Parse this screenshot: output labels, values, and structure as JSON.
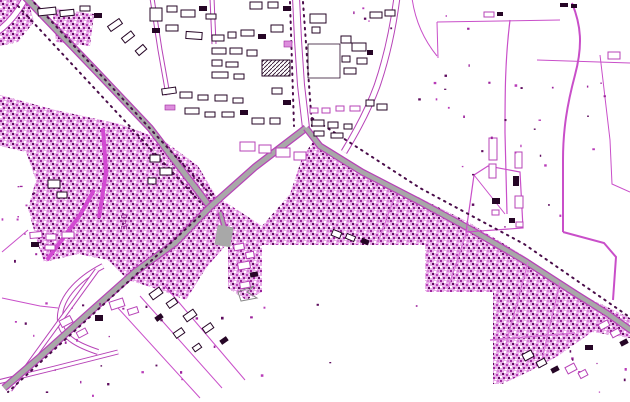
{
  "map": {
    "background": "#ffffff",
    "label": {
      "text": "340",
      "x": 127,
      "y": 230,
      "rotation": -90
    },
    "colors": {
      "road_fill": "#a8a8a8",
      "road_casing": "#b743b7",
      "minor_line": "#c94fc9",
      "strong_line": "#c13fc1",
      "bright_street": "#d24ad2",
      "band_street": "#d678d6",
      "tree_dots": "#4a0d4a",
      "dark_ink": "#260626",
      "texture_base": "#e8b0e8",
      "texture_mid": "#b83cb8",
      "texture_dark": "#9c239c",
      "texture_deep": "#5f0d5f",
      "texture_light": "#d77fd7",
      "building_pink": "#dd8edd",
      "label_color": "#8a1f8a",
      "gray_outline": "#8a8a8a"
    },
    "texture_areas": [
      "0,95 55,110 120,124 163,140 198,166 216,196 262,226 262,245 226,245 206,268 186,300 160,290 128,280 108,260 78,254 44,262 36,238 28,208 36,180 26,152 0,146",
      "0,0 28,0 34,22 18,42 0,46",
      "52,8 94,14 90,46 56,42",
      "262,226 290,194 302,158 314,140 334,152 364,172 420,198 468,222 524,256 576,292 630,318 630,338 592,332 558,356 528,372 502,384 493,384 493,292 425,292 425,245 262,245",
      "228,228 262,228 262,292 246,300 228,288"
    ],
    "gray_roads": [
      {
        "d": "M 24,-4 L 95,70 L 150,128 L 210,207",
        "w": 5
      },
      {
        "d": "M 210,207 L 175,243 L 135,272 L 90,312 L 40,357 L 4,388",
        "w": 5
      },
      {
        "d": "M 210,207 L 255,167 L 306,128",
        "w": 5
      },
      {
        "d": "M 306,128 L 320,146 L 362,172 L 420,202 L 470,229 L 525,261 L 576,294 L 608,314 L 632,331",
        "w": 4.5
      },
      {
        "d": "M 220,212 L 227,236",
        "w": 3
      }
    ],
    "gray_patches": [
      {
        "x": 216,
        "y": 226,
        "w": 16,
        "h": 20,
        "r": 10
      }
    ],
    "white_roads": [
      {
        "d": "M 296,-3 L 298,40 L 301,85 L 306,128",
        "w": 6
      },
      {
        "d": "M -3,32 Q 14,20 26,-3",
        "w": 5
      },
      {
        "d": "M 397,-3 Q 391,45 377,86 Q 366,116 344,152",
        "w": 5
      },
      {
        "d": "M 103,266 C 76,280 58,300 60,322 C 62,338 80,346 98,352",
        "w": 4
      },
      {
        "d": "M 97,270 L 10,390",
        "w": 3
      },
      {
        "d": "M -2,382 L 55,368 L 118,352",
        "w": 3
      },
      {
        "d": "M 152,-2 L 160,50 L 168,95",
        "w": 3
      },
      {
        "d": "M 212,-2 L 214,44",
        "w": 3
      }
    ],
    "bright_streets": [
      {
        "d": "M 103,128 L 106,172 L 99,218",
        "w": 4
      },
      {
        "d": "M 47,260 L 80,215 L 94,190",
        "w": 4
      }
    ],
    "band_streets": [
      {
        "d": "M 395,196 L 378,242",
        "w": 1.3
      },
      {
        "d": "M 468,228 L 448,288",
        "w": 1.3
      },
      {
        "d": "M 528,262 L 506,344",
        "w": 1.3
      },
      {
        "d": "M 560,282 L 540,368",
        "w": 1.3
      },
      {
        "d": "M 490,340 L 575,333",
        "w": 1.5
      }
    ],
    "field_lines": [
      {
        "d": "M 437,22 L 560,20",
        "w": 1
      },
      {
        "d": "M 437,22 L 438,58",
        "w": 1
      },
      {
        "d": "M 510,20 C 505,60 505,95 505,133 L 507,214",
        "w": 1.2
      },
      {
        "d": "M 572,3 C 581,25 583,45 575,75 C 567,105 563,130 563,160 L 563,232",
        "w": 2
      },
      {
        "d": "M 563,232 L 604,243 L 616,257 L 613,300",
        "w": 2
      },
      {
        "d": "M 466,232 L 474,175 L 488,166 L 520,172 L 523,228 Z",
        "w": 1.2
      },
      {
        "d": "M 474,175 L 505,214",
        "w": 1
      },
      {
        "d": "M 600,55 L 610,140 L 612,184 L 630,192",
        "w": 1
      },
      {
        "d": "M 537,60 L 630,63",
        "w": 1
      },
      {
        "d": "M 412,-2 C 415,20 424,40 437,56",
        "w": 1
      },
      {
        "d": "M 118,308 L 200,398",
        "w": 1
      },
      {
        "d": "M 140,296 L 222,388",
        "w": 1
      },
      {
        "d": "M 165,286 L 245,380",
        "w": 1
      },
      {
        "d": "M 28,230 L 2,252",
        "w": 1
      },
      {
        "d": "M 2,298 L 40,306 L 58,308",
        "w": 1
      }
    ],
    "tree_lines": [
      "M 312,118 L 420,188 L 524,244 L 628,316",
      "M 18,6 L 200,202",
      "M 30,-2 L 212,196",
      "M 200,216 L 8,392",
      "M 290,2 L 294,126",
      "M 303,2 L 312,126"
    ],
    "outline_paths": [
      {
        "d": "M 308,44 L 340,44 L 340,78 L 308,78 Z",
        "stroke": "#260626",
        "w": 0.8
      },
      {
        "d": "M 238,292 L 254,286 L 247,292 L 257,298 L 241,301 Z",
        "stroke": "#8a8a8a",
        "w": 1
      }
    ],
    "buildings": [
      [
        38,
        8,
        18,
        7,
        -6,
        "d"
      ],
      [
        60,
        10,
        14,
        6,
        -6,
        "d"
      ],
      [
        80,
        6,
        10,
        5,
        0,
        "d"
      ],
      [
        94,
        13,
        8,
        5,
        0,
        "k"
      ],
      [
        108,
        22,
        14,
        6,
        -35,
        "d"
      ],
      [
        122,
        34,
        12,
        6,
        -38,
        "d"
      ],
      [
        136,
        47,
        10,
        6,
        -40,
        "d"
      ],
      [
        150,
        8,
        12,
        13,
        0,
        "d"
      ],
      [
        167,
        6,
        10,
        6,
        0,
        "d"
      ],
      [
        181,
        10,
        14,
        7,
        0,
        "d"
      ],
      [
        199,
        6,
        8,
        5,
        0,
        "k"
      ],
      [
        206,
        14,
        10,
        5,
        0,
        "d"
      ],
      [
        152,
        28,
        8,
        5,
        0,
        "k"
      ],
      [
        166,
        25,
        12,
        6,
        0,
        "d"
      ],
      [
        186,
        32,
        16,
        7,
        4,
        "d"
      ],
      [
        212,
        35,
        12,
        6,
        0,
        "d"
      ],
      [
        228,
        32,
        8,
        6,
        0,
        "d"
      ],
      [
        241,
        30,
        13,
        6,
        0,
        "d"
      ],
      [
        258,
        34,
        8,
        5,
        0,
        "k"
      ],
      [
        212,
        48,
        14,
        6,
        0,
        "d"
      ],
      [
        230,
        48,
        12,
        6,
        0,
        "d"
      ],
      [
        247,
        50,
        10,
        6,
        0,
        "d"
      ],
      [
        212,
        60,
        10,
        6,
        0,
        "d"
      ],
      [
        226,
        62,
        12,
        5,
        0,
        "d"
      ],
      [
        212,
        72,
        16,
        6,
        0,
        "d"
      ],
      [
        234,
        74,
        10,
        5,
        0,
        "d"
      ],
      [
        262,
        60,
        28,
        16,
        0,
        "h"
      ],
      [
        250,
        2,
        12,
        7,
        0,
        "d"
      ],
      [
        268,
        2,
        10,
        6,
        0,
        "d"
      ],
      [
        283,
        6,
        8,
        5,
        0,
        "k"
      ],
      [
        271,
        25,
        12,
        7,
        0,
        "d"
      ],
      [
        284,
        41,
        8,
        6,
        0,
        "p"
      ],
      [
        272,
        88,
        10,
        6,
        0,
        "d"
      ],
      [
        283,
        100,
        8,
        5,
        0,
        "k"
      ],
      [
        162,
        88,
        14,
        6,
        -8,
        "d"
      ],
      [
        180,
        92,
        12,
        6,
        0,
        "d"
      ],
      [
        198,
        95,
        10,
        5,
        0,
        "d"
      ],
      [
        215,
        95,
        12,
        6,
        0,
        "d"
      ],
      [
        233,
        98,
        10,
        5,
        0,
        "d"
      ],
      [
        165,
        105,
        10,
        5,
        0,
        "p"
      ],
      [
        185,
        108,
        14,
        6,
        0,
        "d"
      ],
      [
        205,
        112,
        10,
        5,
        0,
        "d"
      ],
      [
        222,
        112,
        12,
        5,
        0,
        "d"
      ],
      [
        240,
        110,
        8,
        5,
        0,
        "k"
      ],
      [
        252,
        118,
        12,
        6,
        0,
        "d"
      ],
      [
        270,
        118,
        10,
        6,
        0,
        "d"
      ],
      [
        240,
        142,
        15,
        9,
        0,
        "o"
      ],
      [
        259,
        145,
        12,
        8,
        0,
        "o"
      ],
      [
        276,
        148,
        14,
        9,
        0,
        "o"
      ],
      [
        294,
        152,
        12,
        8,
        0,
        "o"
      ],
      [
        310,
        14,
        16,
        9,
        0,
        "d"
      ],
      [
        312,
        27,
        8,
        6,
        0,
        "d"
      ],
      [
        370,
        12,
        12,
        6,
        0,
        "d"
      ],
      [
        385,
        10,
        10,
        6,
        0,
        "d"
      ],
      [
        341,
        36,
        10,
        7,
        0,
        "d"
      ],
      [
        352,
        43,
        14,
        8,
        0,
        "d"
      ],
      [
        342,
        56,
        8,
        6,
        0,
        "d"
      ],
      [
        357,
        58,
        10,
        6,
        0,
        "d"
      ],
      [
        344,
        68,
        12,
        6,
        0,
        "d"
      ],
      [
        367,
        50,
        6,
        5,
        0,
        "k"
      ],
      [
        366,
        100,
        8,
        6,
        0,
        "d"
      ],
      [
        377,
        104,
        10,
        6,
        0,
        "d"
      ],
      [
        310,
        108,
        8,
        5,
        0,
        "o"
      ],
      [
        322,
        108,
        8,
        5,
        0,
        "o"
      ],
      [
        336,
        106,
        8,
        5,
        0,
        "o"
      ],
      [
        350,
        106,
        10,
        5,
        0,
        "o"
      ],
      [
        312,
        120,
        12,
        6,
        0,
        "d"
      ],
      [
        328,
        122,
        10,
        6,
        0,
        "d"
      ],
      [
        344,
        124,
        8,
        5,
        0,
        "d"
      ],
      [
        314,
        131,
        10,
        5,
        0,
        "d"
      ],
      [
        331,
        133,
        12,
        5,
        0,
        "d"
      ],
      [
        484,
        12,
        10,
        5,
        0,
        "o"
      ],
      [
        497,
        12,
        6,
        4,
        0,
        "k"
      ],
      [
        560,
        3,
        8,
        4,
        0,
        "k"
      ],
      [
        571,
        4,
        6,
        4,
        0,
        "k"
      ],
      [
        608,
        52,
        12,
        7,
        0,
        "o"
      ],
      [
        489,
        138,
        8,
        22,
        0,
        "o"
      ],
      [
        489,
        164,
        7,
        14,
        0,
        "o"
      ],
      [
        515,
        152,
        7,
        16,
        0,
        "o"
      ],
      [
        513,
        176,
        6,
        10,
        0,
        "k"
      ],
      [
        492,
        198,
        8,
        6,
        0,
        "k"
      ],
      [
        515,
        196,
        8,
        12,
        0,
        "o"
      ],
      [
        492,
        210,
        7,
        5,
        0,
        "o"
      ],
      [
        509,
        218,
        6,
        5,
        0,
        "k"
      ],
      [
        516,
        222,
        7,
        5,
        0,
        "o"
      ],
      [
        48,
        180,
        12,
        8,
        0,
        "d"
      ],
      [
        57,
        192,
        10,
        6,
        0,
        "d"
      ],
      [
        150,
        155,
        10,
        7,
        0,
        "d"
      ],
      [
        160,
        168,
        12,
        7,
        0,
        "d"
      ],
      [
        148,
        178,
        8,
        6,
        0,
        "d"
      ],
      [
        30,
        232,
        12,
        6,
        -5,
        "o"
      ],
      [
        46,
        234,
        10,
        6,
        0,
        "o"
      ],
      [
        62,
        232,
        12,
        6,
        0,
        "o"
      ],
      [
        31,
        242,
        8,
        5,
        0,
        "k"
      ],
      [
        45,
        245,
        10,
        5,
        0,
        "o"
      ],
      [
        110,
        300,
        14,
        8,
        -18,
        "o"
      ],
      [
        128,
        308,
        10,
        6,
        -18,
        "o"
      ],
      [
        95,
        315,
        8,
        6,
        0,
        "k"
      ],
      [
        60,
        318,
        12,
        7,
        -28,
        "o"
      ],
      [
        77,
        330,
        10,
        6,
        -28,
        "o"
      ],
      [
        150,
        290,
        12,
        7,
        -35,
        "d"
      ],
      [
        167,
        300,
        10,
        6,
        -35,
        "d"
      ],
      [
        184,
        312,
        12,
        7,
        -35,
        "d"
      ],
      [
        203,
        325,
        10,
        6,
        -35,
        "d"
      ],
      [
        220,
        338,
        8,
        5,
        -35,
        "k"
      ],
      [
        155,
        315,
        8,
        5,
        -35,
        "k"
      ],
      [
        174,
        330,
        10,
        6,
        -35,
        "d"
      ],
      [
        193,
        345,
        8,
        5,
        -35,
        "d"
      ],
      [
        234,
        244,
        10,
        6,
        -10,
        "o"
      ],
      [
        246,
        252,
        8,
        6,
        -10,
        "o"
      ],
      [
        238,
        262,
        12,
        7,
        -10,
        "o"
      ],
      [
        250,
        272,
        8,
        5,
        -10,
        "k"
      ],
      [
        240,
        282,
        10,
        6,
        -10,
        "o"
      ],
      [
        332,
        231,
        9,
        6,
        22,
        "d"
      ],
      [
        346,
        235,
        9,
        5,
        22,
        "d"
      ],
      [
        361,
        239,
        8,
        5,
        22,
        "k"
      ],
      [
        523,
        352,
        10,
        7,
        -28,
        "d"
      ],
      [
        537,
        360,
        9,
        6,
        -28,
        "d"
      ],
      [
        551,
        367,
        8,
        5,
        -28,
        "k"
      ],
      [
        566,
        365,
        10,
        7,
        -28,
        "o"
      ],
      [
        579,
        371,
        8,
        6,
        -28,
        "o"
      ],
      [
        599,
        322,
        10,
        6,
        -28,
        "o"
      ],
      [
        611,
        330,
        9,
        6,
        -28,
        "o"
      ],
      [
        620,
        340,
        8,
        5,
        -28,
        "k"
      ],
      [
        585,
        345,
        8,
        5,
        0,
        "k"
      ]
    ],
    "speckle_zones": [
      {
        "x": 430,
        "y": 60,
        "w": 100,
        "h": 170,
        "count": 12,
        "seed": 11
      },
      {
        "x": 520,
        "y": 80,
        "w": 108,
        "h": 150,
        "count": 14,
        "seed": 22
      },
      {
        "x": 400,
        "y": 0,
        "w": 80,
        "h": 120,
        "count": 8,
        "seed": 33
      },
      {
        "x": 0,
        "y": 150,
        "w": 40,
        "h": 110,
        "count": 12,
        "seed": 44
      },
      {
        "x": 0,
        "y": 300,
        "w": 240,
        "h": 95,
        "count": 26,
        "seed": 55
      },
      {
        "x": 560,
        "y": 350,
        "w": 66,
        "h": 48,
        "count": 8,
        "seed": 66
      },
      {
        "x": 240,
        "y": 300,
        "w": 180,
        "h": 90,
        "count": 6,
        "seed": 77
      },
      {
        "x": 340,
        "y": 0,
        "w": 60,
        "h": 40,
        "count": 5,
        "seed": 88
      }
    ]
  }
}
